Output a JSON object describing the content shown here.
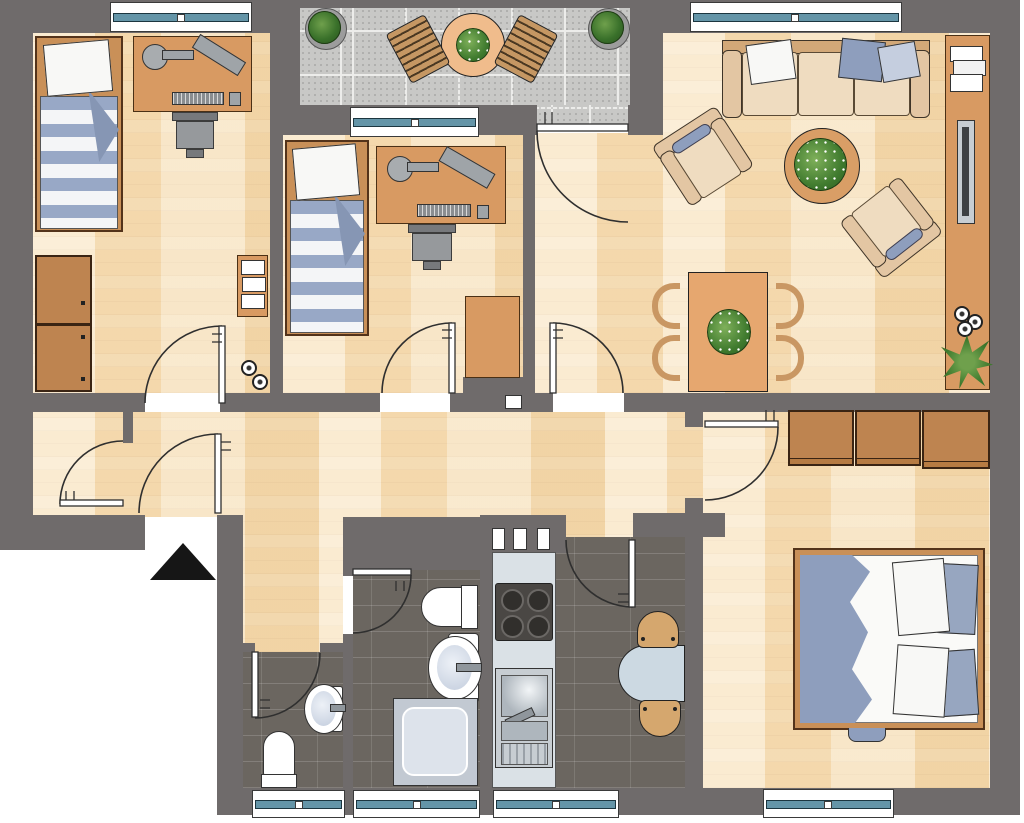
{
  "palette": {
    "wall": "#6F6B6B",
    "wood": "#F4DCB8",
    "tile_dark": "#6B6660",
    "balcony_tile": "#C8C8C6",
    "window_teal": "#6495A8",
    "furniture_tan": "#D89A62",
    "wardrobe_tan": "#BE8450",
    "fabric_cream": "#EFDCC0",
    "fabric_beige": "#E3C6A3",
    "textile_blue": "#8E9EBD",
    "textile_blue_light": "#C5CEDF",
    "counter_gray": "#DAE1E6",
    "steel_gray": "#C7CDD2",
    "kitchen_table_blue": "#CCD9E2",
    "chair_wood": "#D5A76E",
    "plant_green": "#3F7A2E",
    "entrance_marker": "#161616",
    "outline": "#2F2F2F",
    "white": "#FFFFFF"
  },
  "plan": {
    "type": "apartment-floor-plan",
    "window_count": 7,
    "door_count": 10,
    "entrance": "black-triangle-marker-at-south-west-entry",
    "rooms": [
      {
        "name": "balcony",
        "floor": "gray-tiles",
        "furniture": [
          "round-table-with-plant",
          "slat-chair-left",
          "slat-chair-right",
          "potted-plant-left",
          "potted-plant-right"
        ]
      },
      {
        "name": "child-bedroom-1",
        "floor": "wood",
        "furniture": [
          "single-bed-striped",
          "desk-with-lamp-monitor-keyboard",
          "desk-chair",
          "wardrobe",
          "shelf-with-towels",
          "deco-candles"
        ]
      },
      {
        "name": "child-bedroom-2",
        "floor": "wood",
        "furniture": [
          "single-bed-striped",
          "desk-with-lamp-monitor-keyboard",
          "desk-chair",
          "cabinet"
        ]
      },
      {
        "name": "living-dining-room",
        "floor": "wood",
        "furniture": [
          "sofa-three-seats-with-pillows",
          "armchair-left",
          "armchair-right",
          "round-coffee-table-with-plant",
          "dining-table-with-plant",
          "dining-chairs-x4",
          "sideboard",
          "book-stack",
          "tv-panel",
          "tea-candles-x3",
          "corner-plant"
        ]
      },
      {
        "name": "hallway",
        "floor": "wood",
        "furniture": [
          "entrance-door",
          "closet-door"
        ]
      },
      {
        "name": "master-bedroom",
        "floor": "wood",
        "furniture": [
          "wardrobe-unit-1",
          "wardrobe-unit-2",
          "wardrobe-unit-3",
          "double-bed-with-blue-blanket-and-pillows"
        ]
      },
      {
        "name": "kitchen",
        "floor": "dark-tiles",
        "furniture": [
          "counter",
          "stove-4-burners",
          "sink-with-drainer",
          "round-table-blue",
          "wood-chair-top",
          "wood-chair-bottom",
          "vent-shaft"
        ]
      },
      {
        "name": "bathroom",
        "floor": "dark-tiles",
        "furniture": [
          "toilet",
          "washbasin",
          "shower"
        ]
      },
      {
        "name": "wc",
        "floor": "dark-tiles",
        "furniture": [
          "washbasin",
          "toilet"
        ]
      }
    ]
  }
}
